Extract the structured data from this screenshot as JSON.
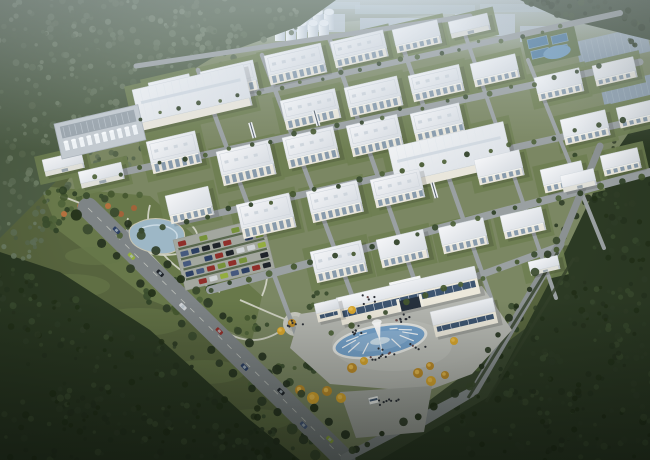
{
  "meta": {
    "description": "Aerial dusk rendering of an industrial park campus with white factory buildings, silos, tank farm, central gate building with fountain plaza, park, parking lot and forest surroundings",
    "width": 650,
    "height": 460,
    "rotation_deg": -13
  },
  "palette": {
    "field": "#57643e",
    "campus": "#7b8763",
    "park": "#68784a",
    "lawn": "#6e7e51",
    "forest_haze": "#4d5d45",
    "forest_dark": "#2c3a24",
    "forest_bottom": "#2a3822",
    "forest_strip": "#36452f",
    "dark_lawn": "#3a4830",
    "haze1": "#b4bfc9",
    "haze2": "#a9b6c2",
    "haze3": "#bac5ce",
    "haze_glass": "#8fa6ad",
    "road": "#9aa0a2",
    "road_dark": "#7e8486",
    "road_edge": "#c6c9c2",
    "path": "#d6d7cb",
    "roof_a": "#f3f5f7",
    "roof_b": "#d9dee4",
    "wh_a": "#eef0f3",
    "wh_b": "#dde2e8",
    "wall": "#e9e6dc",
    "wall_shade": "#bfc5cd",
    "glass": "#7d92a6",
    "glass_dark": "#3e5570",
    "arch": "#26313d",
    "silo_a": "#f4f8fa",
    "silo_b": "#c6d1da",
    "water": "#9db7c6",
    "pool": "#76a3cc",
    "pool_light": "#8fb5d6",
    "pond": "#6f9cc0",
    "plaza": "#b6b8b2",
    "plaza_light": "#c3c5bf",
    "apron": "#a6a9a3",
    "yellow_tree": "#d8a62e",
    "yellow_tree_dark": "#bd8c2a",
    "autumn": "#a2633a",
    "people": "#2b2f36",
    "hedge": "#33402a",
    "tank_pad": "#c3cad0",
    "pipe_rack": "#9aa4ac",
    "distant_wh": "#8ea0b0",
    "treat_pool": "#4f7da3",
    "car_colors": [
      "#2c3f63",
      "#93ad3f",
      "#1f242a",
      "#cfd3d6",
      "#8f2f2a",
      "#46597e",
      "#77923a"
    ],
    "tree_mid": [
      "#3a4c2e",
      "#44572f",
      "#2f4026",
      "#4e6238"
    ],
    "tree_dark": [
      "#26331f",
      "#2f3d27",
      "#394a2e",
      "#223018"
    ],
    "tree_haze": [
      "#5f6f57",
      "#6b7b63",
      "#4e5e46",
      "#58684f"
    ]
  },
  "scene": {
    "campus_poly": "136,64 240,30 470,12 650,4 650,240 558,246 470,392 345,460 96,220 58,196 100,130",
    "park_poly": "40,186 150,196 262,296 252,340 150,300 58,230",
    "dark_lawn_poly": "350,460 650,235 650,460",
    "forest": [
      {
        "poly": "0,0 336,0 300,26 212,58 150,96 86,150 40,198 0,238",
        "fill": "forest_haze"
      },
      {
        "poly": "650,120 650,460 380,460 490,396 566,250 606,166 632,128",
        "fill": "forest_dark"
      },
      {
        "poly": "0,252 60,272 150,330 250,420 300,460 0,460",
        "fill": "forest_bottom"
      },
      {
        "poly": "520,0 650,0 650,40 560,18",
        "fill": "forest_strip"
      }
    ],
    "forest_clusters": [
      [
        40,
        30,
        70,
        40,
        80,
        "haze"
      ],
      [
        130,
        35,
        85,
        42,
        90,
        "haze"
      ],
      [
        235,
        22,
        70,
        28,
        60,
        "haze"
      ],
      [
        60,
        110,
        75,
        48,
        80,
        "haze"
      ],
      [
        150,
        92,
        62,
        36,
        55,
        "haze"
      ],
      [
        30,
        180,
        48,
        36,
        45,
        "haze"
      ],
      [
        105,
        150,
        45,
        28,
        38,
        "haze"
      ],
      [
        215,
        58,
        52,
        24,
        35,
        "haze"
      ],
      [
        20,
        240,
        30,
        20,
        22,
        "haze"
      ],
      [
        612,
        168,
        45,
        55,
        45,
        "dark"
      ],
      [
        592,
        258,
        58,
        68,
        55,
        "dark"
      ],
      [
        560,
        348,
        66,
        66,
        60,
        "dark"
      ],
      [
        520,
        420,
        76,
        48,
        55,
        "dark"
      ],
      [
        634,
        320,
        36,
        76,
        40,
        "dark"
      ],
      [
        598,
        430,
        60,
        36,
        35,
        "dark"
      ],
      [
        40,
        328,
        62,
        38,
        40,
        "dark"
      ],
      [
        120,
        378,
        80,
        48,
        60,
        "dark"
      ],
      [
        205,
        428,
        78,
        40,
        55,
        "dark"
      ],
      [
        60,
        432,
        70,
        36,
        45,
        "dark"
      ],
      [
        275,
        452,
        55,
        22,
        28,
        "dark"
      ],
      [
        10,
        290,
        30,
        25,
        20,
        "dark"
      ],
      [
        568,
        6,
        55,
        10,
        24,
        "dark"
      ],
      [
        640,
        26,
        18,
        26,
        16,
        "dark"
      ]
    ],
    "field_patches": [
      [
        70,
        286,
        40,
        12
      ],
      [
        140,
        322,
        46,
        14
      ],
      [
        205,
        372,
        40,
        12
      ],
      [
        95,
        256,
        30,
        9
      ],
      [
        255,
        420,
        36,
        11
      ]
    ],
    "shadow_streaks": [
      [
        14,
        298,
        96,
        318
      ],
      [
        60,
        330,
        150,
        352
      ],
      [
        120,
        372,
        210,
        396
      ],
      [
        40,
        408,
        130,
        432
      ]
    ],
    "haze_blocks": [
      [
        150,
        18,
        60,
        22
      ],
      [
        215,
        8,
        70,
        24
      ],
      [
        290,
        14,
        55,
        18
      ],
      [
        360,
        18,
        90,
        28
      ],
      [
        455,
        14,
        60,
        22
      ],
      [
        520,
        26,
        48,
        16
      ]
    ],
    "haze_glass_strips": [
      [
        355,
        5,
        120,
        9
      ],
      [
        480,
        4,
        170,
        8
      ],
      [
        300,
        2,
        60,
        7
      ]
    ],
    "cooling_domes": [
      [
        440,
        34
      ],
      [
        456,
        32
      ],
      [
        472,
        30
      ]
    ],
    "silos": {
      "x": 269,
      "y": 9,
      "w": 10,
      "h": 18,
      "gap": 11,
      "back": 6,
      "front": 5
    },
    "distant_warehouses": [
      [
        575,
        42,
        72,
        26
      ],
      [
        600,
        86,
        54,
        20
      ]
    ],
    "treatment_pools": {
      "x": 527,
      "y": 40
    },
    "roads_h": [
      [
        136,
        66,
        470,
        16,
        5
      ],
      [
        140,
        118,
        620,
        13,
        6
      ],
      [
        96,
        178,
        640,
        62,
        7
      ],
      [
        120,
        235,
        648,
        118,
        7
      ],
      [
        210,
        290,
        650,
        172,
        8
      ],
      [
        330,
        330,
        560,
        246,
        7
      ]
    ],
    "roads_v": [
      [
        198,
        70,
        300,
        345,
        4.5
      ],
      [
        262,
        55,
        368,
        338,
        4.5
      ],
      [
        330,
        40,
        432,
        330,
        4.5
      ],
      [
        396,
        28,
        498,
        318,
        4.5
      ],
      [
        460,
        20,
        556,
        298,
        4
      ],
      [
        528,
        60,
        604,
        248,
        4
      ]
    ],
    "boulevard": {
      "x1": 88,
      "y1": 208,
      "x2": 345,
      "y2": 460,
      "w": 21
    },
    "perimeter": [
      [
        345,
        458,
        475,
        390,
        9
      ],
      [
        475,
        390,
        560,
        244,
        9
      ],
      [
        560,
        244,
        600,
        146,
        7
      ],
      [
        398,
        332,
        420,
        425,
        6
      ],
      [
        420,
        425,
        472,
        394,
        6
      ]
    ],
    "hedge_lines": [
      [
        468,
        398,
        558,
        252
      ],
      [
        486,
        402,
        574,
        258
      ]
    ],
    "buildings": [
      {
        "x": 148,
        "y": 83,
        "w": 42,
        "d": 16,
        "h": 8,
        "t": "o"
      },
      {
        "x": 200,
        "y": 72,
        "w": 54,
        "d": 20,
        "h": 10,
        "t": "o"
      },
      {
        "x": 264,
        "y": 56,
        "w": 58,
        "d": 20,
        "h": 10,
        "t": "o"
      },
      {
        "x": 330,
        "y": 42,
        "w": 54,
        "d": 18,
        "h": 9,
        "t": "o"
      },
      {
        "x": 392,
        "y": 30,
        "w": 46,
        "d": 16,
        "h": 8,
        "t": "o"
      },
      {
        "x": 448,
        "y": 22,
        "w": 40,
        "d": 12,
        "h": 5,
        "t": "s"
      },
      {
        "x": 132,
        "y": 90,
        "w": 114,
        "d": 34,
        "h": 8,
        "t": "w"
      },
      {
        "x": 280,
        "y": 101,
        "w": 56,
        "d": 20,
        "h": 10,
        "t": "o"
      },
      {
        "x": 344,
        "y": 88,
        "w": 54,
        "d": 20,
        "h": 10,
        "t": "o"
      },
      {
        "x": 408,
        "y": 76,
        "w": 52,
        "d": 18,
        "h": 9,
        "t": "o"
      },
      {
        "x": 470,
        "y": 64,
        "w": 46,
        "d": 16,
        "h": 8,
        "t": "o"
      },
      {
        "x": 534,
        "y": 78,
        "w": 46,
        "d": 16,
        "h": 8,
        "t": "o"
      },
      {
        "x": 592,
        "y": 66,
        "w": 42,
        "d": 14,
        "h": 7,
        "t": "o"
      },
      {
        "x": 42,
        "y": 160,
        "w": 40,
        "d": 12,
        "h": 5,
        "t": "s"
      },
      {
        "x": 78,
        "y": 172,
        "w": 44,
        "d": 12,
        "h": 5,
        "t": "s"
      },
      {
        "x": 146,
        "y": 142,
        "w": 50,
        "d": 22,
        "h": 11,
        "t": "o"
      },
      {
        "x": 216,
        "y": 152,
        "w": 54,
        "d": 24,
        "h": 11,
        "t": "o"
      },
      {
        "x": 282,
        "y": 138,
        "w": 52,
        "d": 22,
        "h": 10,
        "t": "o"
      },
      {
        "x": 346,
        "y": 126,
        "w": 52,
        "d": 22,
        "h": 10,
        "t": "o"
      },
      {
        "x": 410,
        "y": 114,
        "w": 50,
        "d": 20,
        "h": 9,
        "t": "o"
      },
      {
        "x": 560,
        "y": 120,
        "w": 46,
        "d": 18,
        "h": 8,
        "t": "o"
      },
      {
        "x": 616,
        "y": 108,
        "w": 38,
        "d": 14,
        "h": 7,
        "t": "o"
      },
      {
        "x": 388,
        "y": 148,
        "w": 118,
        "d": 36,
        "h": 8,
        "t": "w"
      },
      {
        "x": 165,
        "y": 196,
        "w": 44,
        "d": 20,
        "h": 9,
        "t": "o"
      },
      {
        "x": 236,
        "y": 205,
        "w": 54,
        "d": 24,
        "h": 11,
        "t": "o"
      },
      {
        "x": 306,
        "y": 192,
        "w": 52,
        "d": 22,
        "h": 10,
        "t": "o"
      },
      {
        "x": 370,
        "y": 180,
        "w": 50,
        "d": 20,
        "h": 9,
        "t": "o"
      },
      {
        "x": 474,
        "y": 160,
        "w": 46,
        "d": 18,
        "h": 8,
        "t": "o"
      },
      {
        "x": 540,
        "y": 170,
        "w": 42,
        "d": 16,
        "h": 8,
        "t": "o"
      },
      {
        "x": 600,
        "y": 156,
        "w": 38,
        "d": 14,
        "h": 7,
        "t": "o"
      },
      {
        "x": 560,
        "y": 176,
        "w": 34,
        "d": 12,
        "h": 5,
        "t": "s"
      },
      {
        "x": 310,
        "y": 252,
        "w": 52,
        "d": 22,
        "h": 10,
        "t": "o"
      },
      {
        "x": 376,
        "y": 240,
        "w": 48,
        "d": 20,
        "h": 9,
        "t": "o"
      },
      {
        "x": 438,
        "y": 228,
        "w": 46,
        "d": 18,
        "h": 9,
        "t": "o"
      },
      {
        "x": 500,
        "y": 216,
        "w": 42,
        "d": 16,
        "h": 8,
        "t": "o"
      },
      {
        "x": 528,
        "y": 262,
        "w": 30,
        "d": 10,
        "h": 4,
        "t": "s"
      }
    ],
    "bridges": [
      [
        252,
        122
      ],
      [
        316,
        110
      ],
      [
        434,
        182
      ]
    ],
    "tank_farm": {
      "x": 54,
      "y": 124,
      "w": 86,
      "d": 36
    },
    "lake_path": "M135,224 q18,-10 38,-2 q16,7 10,20 q-7,15 -28,11 q-22,-4 -25,-15 q-3,-10 5,-14",
    "pond": {
      "cx": 557,
      "cy": 52,
      "rx": 14,
      "ry": 6.5
    },
    "park_paths": [
      "M60,196 C110,210 150,250 190,300 C220,336 250,352 282,330",
      "M150,205 C140,240 170,270 220,292",
      "M128,218 C120,246 150,262 186,252 C204,246 200,228 184,220",
      "M240,300 C268,312 280,318 293,322",
      "M262,296 C270,278 268,264 262,250"
    ],
    "park_plaza": {
      "cx": 295,
      "cy": 324,
      "r": 12
    },
    "park_clusters": [
      [
        70,
        200,
        26,
        12,
        12
      ],
      [
        140,
        240,
        30,
        14,
        14
      ],
      [
        200,
        282,
        30,
        16,
        14
      ],
      [
        250,
        322,
        24,
        12,
        10
      ],
      [
        172,
        300,
        38,
        16,
        12
      ],
      [
        232,
        252,
        20,
        10,
        7
      ],
      [
        300,
        362,
        28,
        14,
        10
      ],
      [
        272,
        382,
        22,
        12,
        8
      ],
      [
        60,
        222,
        20,
        10,
        8
      ],
      [
        320,
        300,
        20,
        10,
        6
      ],
      [
        470,
        358,
        26,
        14,
        10
      ],
      [
        505,
        330,
        18,
        10,
        7
      ]
    ],
    "autumn_trees": [
      [
        80,
        206
      ],
      [
        92,
        213
      ],
      [
        108,
        206
      ],
      [
        121,
        214
      ],
      [
        134,
        208
      ],
      [
        64,
        214
      ]
    ],
    "parking": {
      "x": 173,
      "y": 240,
      "rot": -14,
      "w": 92,
      "h": 52,
      "rows": 5,
      "cols": 8
    },
    "tree_lines": [
      [
        140,
        118,
        560,
        26,
        22,
        2.2,
        "mid"
      ],
      [
        96,
        178,
        600,
        68,
        24,
        2.4,
        "mid"
      ],
      [
        120,
        235,
        620,
        122,
        24,
        2.6,
        "mid"
      ],
      [
        210,
        290,
        640,
        175,
        22,
        2.8,
        "mid"
      ],
      [
        330,
        332,
        555,
        248,
        13,
        2.8,
        "mid"
      ],
      [
        74,
        216,
        330,
        466,
        20,
        4.5,
        "dark"
      ],
      [
        102,
        198,
        356,
        448,
        20,
        4.2,
        "dark"
      ],
      [
        470,
        384,
        556,
        240,
        10,
        3.5,
        "dark"
      ],
      [
        350,
        452,
        470,
        386,
        8,
        3.5,
        "dark"
      ],
      [
        48,
        192,
        140,
        196,
        8,
        3,
        "mid"
      ]
    ],
    "gate": {
      "plaza_poly": "300,314 482,286 512,330 472,374 424,392 330,384 290,348",
      "apron_poly": "340,392 432,386 424,432 356,438",
      "main": {
        "x": 336,
        "y": 298,
        "w": 142,
        "d": 12,
        "h": 16
      },
      "right_wing": {
        "x": 430,
        "y": 312,
        "w": 64,
        "d": 14,
        "h": 12
      },
      "left_wing": {
        "x": 314,
        "y": 304,
        "w": 24,
        "d": 10,
        "h": 9
      },
      "booth": {
        "x": 368,
        "y": 398
      }
    },
    "fountain": {
      "cx": 380,
      "cy": 341,
      "rx": 46,
      "ry": 15,
      "rot": -10,
      "jets": 12
    },
    "yellow_trees": [
      [
        300,
        390,
        5
      ],
      [
        313,
        398,
        6
      ],
      [
        327,
        391,
        5
      ],
      [
        341,
        398,
        5
      ],
      [
        352,
        368,
        5
      ],
      [
        364,
        361,
        4
      ],
      [
        418,
        373,
        5
      ],
      [
        431,
        381,
        5
      ],
      [
        445,
        375,
        4
      ],
      [
        454,
        341,
        4
      ],
      [
        292,
        323,
        4
      ],
      [
        281,
        331,
        4
      ],
      [
        430,
        366,
        4
      ],
      [
        352,
        310,
        4
      ]
    ],
    "people_clusters": [
      [
        381,
        354,
        16,
        12
      ],
      [
        358,
        330,
        10,
        7
      ],
      [
        402,
        318,
        9,
        9
      ],
      [
        390,
        402,
        12,
        8
      ],
      [
        295,
        324,
        8,
        6
      ],
      [
        420,
        345,
        10,
        5
      ],
      [
        370,
        300,
        12,
        6
      ]
    ],
    "road_cars": [
      [
        0.1,
        0,
        -4
      ],
      [
        0.18,
        1,
        4
      ],
      [
        0.27,
        2,
        -4
      ],
      [
        0.38,
        3,
        4
      ],
      [
        0.5,
        4,
        -4
      ],
      [
        0.62,
        0,
        4
      ],
      [
        0.74,
        2,
        -4
      ],
      [
        0.85,
        5,
        4
      ],
      [
        0.93,
        1,
        -4
      ]
    ]
  }
}
